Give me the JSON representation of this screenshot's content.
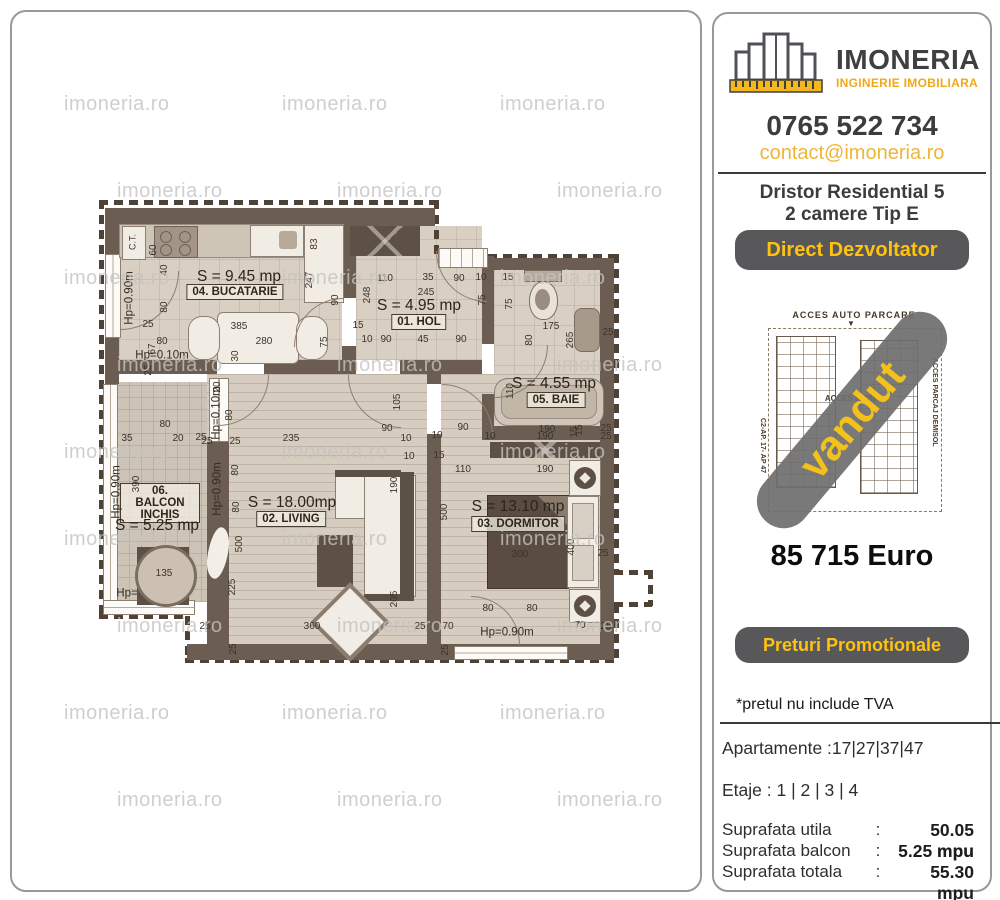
{
  "watermark": {
    "text": "imoneria.ro"
  },
  "right_panel": {
    "logo": {
      "title": "IMONERIA",
      "subtitle": "INGINERIE IMOBILIARA"
    },
    "phone": "0765 522 734",
    "email": "contact@imoneria.ro",
    "project": {
      "line1": "Dristor Residential 5",
      "line2": "2 camere Tip E"
    },
    "badge_direct": "Direct Dezvoltator",
    "site_plan": {
      "top_label": "ACCES  AUTO  PARCARE",
      "arrow": "▼",
      "center_label": "ACCES IMOBIL",
      "left_label": "C2-AP. 17- AP 47",
      "right_label": "ACCES PARCAJ DEMISOL",
      "sold_banner": "vandut"
    },
    "price": "85 715 Euro",
    "badge_promo": "Preturi Promotionale",
    "tva_note": "*pretul nu include TVA",
    "apartments": "Apartamente :17|27|37|47",
    "floors_line": "Etaje : 1 | 2 | 3 | 4",
    "areas": [
      {
        "label": "Suprafata utila",
        "sep": ":",
        "value": "50.05 mpu"
      },
      {
        "label": "Suprafata balcon",
        "sep": ":",
        "value": "5.25 mpu"
      },
      {
        "label": "Suprafata totala",
        "sep": ":",
        "value": "55.30 mpu"
      }
    ],
    "colors": {
      "accent_yellow": "#f0ad1c",
      "button_gray": "#58585a",
      "banner_gray": "#6e6e6e"
    }
  },
  "floor_plan": {
    "ct_label": "C.T.",
    "rooms": [
      {
        "id": "bucatarie",
        "area_label": "S = 9.45 mp",
        "name_label": "04. BUCATARIE"
      },
      {
        "id": "hol",
        "area_label": "S = 4.95 mp",
        "name_label": "01. HOL"
      },
      {
        "id": "baie",
        "area_label": "S = 4.55 mp",
        "name_label": "05. BAIE"
      },
      {
        "id": "living",
        "area_label": "S = 18.00mp",
        "name_label": "02. LIVING"
      },
      {
        "id": "dormitor",
        "area_label": "S = 13.10 mp",
        "name_label": "03. DORMITOR"
      },
      {
        "id": "balcon",
        "area_label": "S = 5.25 mp",
        "name_label": "06. BALCON INCHIS"
      }
    ],
    "hp_labels": [
      [
        "Hp=0.90m",
        128,
        296,
        1
      ],
      [
        "Hp=0.10m",
        160,
        354,
        0
      ],
      [
        "Hp=0.90m",
        115,
        490,
        1
      ],
      [
        "Hp=0.10m",
        215,
        411,
        1
      ],
      [
        "Hp=0.90m",
        216,
        487,
        1
      ],
      [
        "Hp=0.90m",
        505,
        631,
        0
      ],
      [
        "Hp=",
        125,
        592,
        0
      ]
    ],
    "dimensions": [
      [
        "60",
        152,
        248,
        1
      ],
      [
        "40",
        163,
        268,
        1
      ],
      [
        "80",
        163,
        305,
        1
      ],
      [
        "25",
        146,
        323,
        0
      ],
      [
        "80",
        160,
        340,
        0
      ],
      [
        "67",
        151,
        347,
        1
      ],
      [
        "25",
        147,
        368,
        1
      ],
      [
        "385",
        237,
        325,
        0
      ],
      [
        "280",
        262,
        340,
        0
      ],
      [
        "30",
        234,
        354,
        1
      ],
      [
        "247",
        308,
        278,
        1
      ],
      [
        "90",
        334,
        298,
        1
      ],
      [
        "75",
        323,
        340,
        1
      ],
      [
        "83",
        313,
        242,
        1
      ],
      [
        "110",
        383,
        277,
        0
      ],
      [
        "35",
        426,
        276,
        0
      ],
      [
        "90",
        457,
        277,
        0
      ],
      [
        "10",
        479,
        276,
        0
      ],
      [
        "245",
        424,
        291,
        0
      ],
      [
        "248",
        366,
        293,
        1
      ],
      [
        "75",
        481,
        298,
        1
      ],
      [
        "15",
        356,
        324,
        0
      ],
      [
        "10",
        365,
        338,
        0
      ],
      [
        "90",
        384,
        338,
        0
      ],
      [
        "45",
        421,
        338,
        0
      ],
      [
        "90",
        459,
        338,
        0
      ],
      [
        "15",
        506,
        276,
        0
      ],
      [
        "75",
        508,
        302,
        1
      ],
      [
        "175",
        549,
        325,
        0
      ],
      [
        "80",
        528,
        338,
        1
      ],
      [
        "265",
        569,
        338,
        1
      ],
      [
        "25",
        606,
        331,
        0
      ],
      [
        "110",
        509,
        389,
        1
      ],
      [
        "190",
        545,
        428,
        0
      ],
      [
        "15",
        578,
        428,
        1
      ],
      [
        "25",
        604,
        427,
        0
      ],
      [
        "90",
        461,
        426,
        0
      ],
      [
        "10",
        435,
        434,
        0
      ],
      [
        "10",
        488,
        435,
        0
      ],
      [
        "190",
        543,
        435,
        0
      ],
      [
        "15",
        573,
        430,
        1
      ],
      [
        "25",
        604,
        435,
        0
      ],
      [
        "110",
        461,
        468,
        0
      ],
      [
        "190",
        543,
        468,
        0
      ],
      [
        "500",
        443,
        510,
        1
      ],
      [
        "300",
        518,
        553,
        0
      ],
      [
        "400",
        570,
        545,
        1
      ],
      [
        "25",
        601,
        552,
        0
      ],
      [
        "80",
        486,
        607,
        0
      ],
      [
        "80",
        530,
        607,
        0
      ],
      [
        "70",
        446,
        625,
        0
      ],
      [
        "70",
        578,
        624,
        0
      ],
      [
        "25",
        444,
        648,
        1
      ],
      [
        "25",
        604,
        625,
        0
      ],
      [
        "20",
        216,
        385,
        1
      ],
      [
        "80",
        228,
        413,
        1
      ],
      [
        "25",
        205,
        440,
        0
      ],
      [
        "25",
        233,
        440,
        0
      ],
      [
        "235",
        289,
        437,
        0
      ],
      [
        "90",
        385,
        427,
        0
      ],
      [
        "105",
        396,
        400,
        1
      ],
      [
        "10",
        404,
        437,
        0
      ],
      [
        "10",
        407,
        455,
        0
      ],
      [
        "15",
        437,
        454,
        0
      ],
      [
        "80",
        234,
        468,
        1
      ],
      [
        "80",
        235,
        505,
        1
      ],
      [
        "500",
        238,
        542,
        1
      ],
      [
        "225",
        231,
        585,
        1
      ],
      [
        "25",
        203,
        625,
        0
      ],
      [
        "360",
        310,
        625,
        0
      ],
      [
        "25",
        232,
        647,
        1
      ],
      [
        "25",
        418,
        625,
        0
      ],
      [
        "190",
        393,
        483,
        1
      ],
      [
        "205",
        393,
        597,
        1
      ],
      [
        "35",
        125,
        437,
        0
      ],
      [
        "80",
        163,
        423,
        0
      ],
      [
        "20",
        176,
        437,
        0
      ],
      [
        "25",
        199,
        436,
        0
      ],
      [
        "390",
        135,
        482,
        1
      ],
      [
        "135",
        162,
        572,
        0
      ]
    ]
  }
}
